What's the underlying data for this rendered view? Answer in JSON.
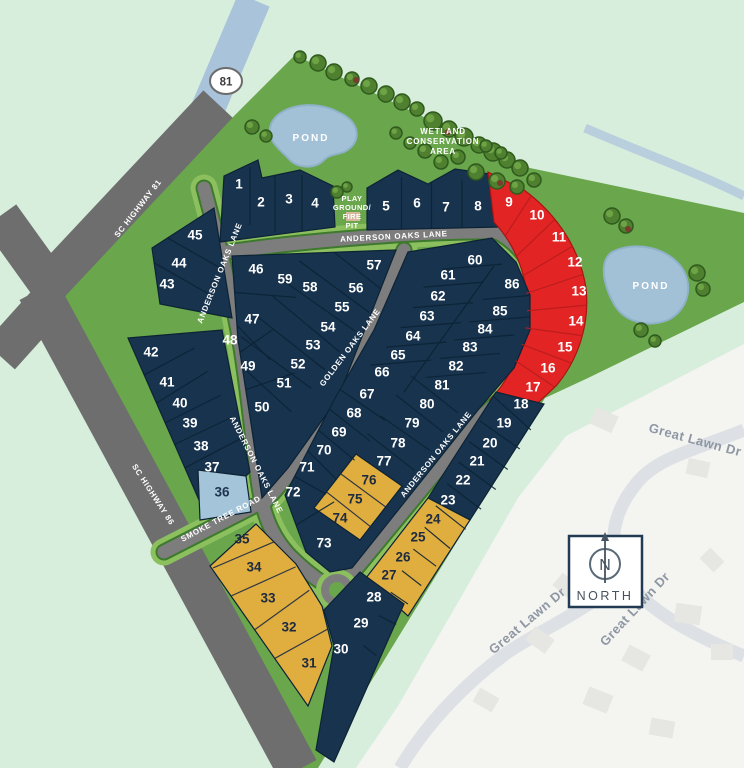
{
  "map_name": "anderson-oaks-site-plan",
  "colors": {
    "mint_background": "#d8eedd",
    "site_green": "#69a64c",
    "road_verge_green": "#8cc05f",
    "lot_navy": "#17334e",
    "lot_red": "#e32424",
    "lot_gold": "#e0ad3f",
    "lot_lightblue": "#a3c4d9",
    "highway_gray": "#6e6e6e",
    "street_gray": "#7d7d7d",
    "pond_blue": "#a3c1d6",
    "neighborhood_offwhite": "#f4f4f1",
    "neighborhood_road": "#dde1e6"
  },
  "highway_shield": "81",
  "compass": {
    "letter": "N",
    "label": "NORTH"
  },
  "road_labels": [
    {
      "text": "SC HIGHWAY 81",
      "x": 140,
      "y": 210,
      "rot": -52
    },
    {
      "text": "ANDERSON OAKS LANE",
      "x": 394,
      "y": 239,
      "rot": -3
    },
    {
      "text": "ANDERSON OAKS LANE",
      "x": 222,
      "y": 274,
      "rot": -68
    },
    {
      "text": "ANDERSON OAKS LANE",
      "x": 254,
      "y": 466,
      "rot": 63
    },
    {
      "text": "ANDERSON OAKS LANE",
      "x": 438,
      "y": 456,
      "rot": -51
    },
    {
      "text": "GOLDEN OAKS LANE",
      "x": 352,
      "y": 349,
      "rot": -53
    },
    {
      "text": "SMOKE TREE ROAD",
      "x": 222,
      "y": 521,
      "rot": -28
    },
    {
      "text": "SC HIGHWAY 86",
      "x": 151,
      "y": 496,
      "rot": 57
    }
  ],
  "area_labels": [
    {
      "text": "POND",
      "x": 311,
      "y": 141,
      "rot": 0,
      "cls": "lbl-area"
    },
    {
      "text": "POND",
      "x": 651,
      "y": 289,
      "rot": 0,
      "cls": "lbl-area"
    },
    {
      "text": "WETLAND",
      "x": 443,
      "y": 134,
      "rot": 0,
      "cls": "lbl-area-sm"
    },
    {
      "text": "CONSERVATION",
      "x": 443,
      "y": 144,
      "rot": 0,
      "cls": "lbl-area-sm"
    },
    {
      "text": "AREA",
      "x": 443,
      "y": 154,
      "rot": 0,
      "cls": "lbl-area-sm"
    },
    {
      "text": "PLAY",
      "x": 352,
      "y": 201,
      "rot": 0,
      "cls": "lbl-play"
    },
    {
      "text": "GROUND/",
      "x": 352,
      "y": 210,
      "rot": 0,
      "cls": "lbl-play"
    },
    {
      "text": "FIRE",
      "x": 352,
      "y": 219,
      "rot": 0,
      "cls": "lbl-play"
    },
    {
      "text": "PIT",
      "x": 352,
      "y": 228,
      "rot": 0,
      "cls": "lbl-play"
    }
  ],
  "street_labels": [
    {
      "text": "Great Lawn Dr",
      "x": 694,
      "y": 444,
      "rot": 15
    },
    {
      "text": "Great Lawn Dr",
      "x": 530,
      "y": 624,
      "rot": -40
    },
    {
      "text": "Great Lawn Dr",
      "x": 638,
      "y": 612,
      "rot": -47
    }
  ],
  "lots": [
    {
      "n": "1",
      "x": 239,
      "y": 184,
      "c": "navy"
    },
    {
      "n": "2",
      "x": 261,
      "y": 202,
      "c": "navy"
    },
    {
      "n": "3",
      "x": 289,
      "y": 199,
      "c": "navy"
    },
    {
      "n": "4",
      "x": 315,
      "y": 203,
      "c": "navy"
    },
    {
      "n": "5",
      "x": 386,
      "y": 206,
      "c": "navy"
    },
    {
      "n": "6",
      "x": 417,
      "y": 203,
      "c": "navy"
    },
    {
      "n": "7",
      "x": 446,
      "y": 207,
      "c": "navy"
    },
    {
      "n": "8",
      "x": 478,
      "y": 206,
      "c": "navy"
    },
    {
      "n": "9",
      "x": 509,
      "y": 202,
      "c": "red"
    },
    {
      "n": "10",
      "x": 537,
      "y": 215,
      "c": "red"
    },
    {
      "n": "11",
      "x": 559,
      "y": 237,
      "c": "red"
    },
    {
      "n": "12",
      "x": 575,
      "y": 262,
      "c": "red"
    },
    {
      "n": "13",
      "x": 579,
      "y": 291,
      "c": "red"
    },
    {
      "n": "14",
      "x": 576,
      "y": 321,
      "c": "red"
    },
    {
      "n": "15",
      "x": 565,
      "y": 347,
      "c": "red"
    },
    {
      "n": "16",
      "x": 548,
      "y": 368,
      "c": "red"
    },
    {
      "n": "17",
      "x": 533,
      "y": 387,
      "c": "red"
    },
    {
      "n": "18",
      "x": 521,
      "y": 404,
      "c": "navy"
    },
    {
      "n": "19",
      "x": 504,
      "y": 423,
      "c": "navy"
    },
    {
      "n": "20",
      "x": 490,
      "y": 443,
      "c": "navy"
    },
    {
      "n": "21",
      "x": 477,
      "y": 461,
      "c": "navy"
    },
    {
      "n": "22",
      "x": 463,
      "y": 480,
      "c": "navy"
    },
    {
      "n": "23",
      "x": 448,
      "y": 500,
      "c": "navy"
    },
    {
      "n": "24",
      "x": 433,
      "y": 519,
      "c": "gold"
    },
    {
      "n": "25",
      "x": 418,
      "y": 537,
      "c": "gold"
    },
    {
      "n": "26",
      "x": 403,
      "y": 557,
      "c": "gold"
    },
    {
      "n": "27",
      "x": 389,
      "y": 575,
      "c": "gold"
    },
    {
      "n": "28",
      "x": 374,
      "y": 597,
      "c": "navy"
    },
    {
      "n": "29",
      "x": 361,
      "y": 623,
      "c": "navy"
    },
    {
      "n": "30",
      "x": 341,
      "y": 649,
      "c": "navy"
    },
    {
      "n": "31",
      "x": 309,
      "y": 663,
      "c": "gold"
    },
    {
      "n": "32",
      "x": 289,
      "y": 627,
      "c": "gold"
    },
    {
      "n": "33",
      "x": 268,
      "y": 598,
      "c": "gold"
    },
    {
      "n": "34",
      "x": 254,
      "y": 567,
      "c": "gold"
    },
    {
      "n": "35",
      "x": 242,
      "y": 539,
      "c": "gold"
    },
    {
      "n": "36",
      "x": 222,
      "y": 492,
      "c": "blue"
    },
    {
      "n": "37",
      "x": 212,
      "y": 467,
      "c": "navy"
    },
    {
      "n": "38",
      "x": 201,
      "y": 446,
      "c": "navy"
    },
    {
      "n": "39",
      "x": 190,
      "y": 423,
      "c": "navy"
    },
    {
      "n": "40",
      "x": 180,
      "y": 403,
      "c": "navy"
    },
    {
      "n": "41",
      "x": 167,
      "y": 382,
      "c": "navy"
    },
    {
      "n": "42",
      "x": 151,
      "y": 352,
      "c": "navy"
    },
    {
      "n": "43",
      "x": 167,
      "y": 284,
      "c": "navy"
    },
    {
      "n": "44",
      "x": 179,
      "y": 263,
      "c": "navy"
    },
    {
      "n": "45",
      "x": 195,
      "y": 235,
      "c": "navy"
    },
    {
      "n": "46",
      "x": 256,
      "y": 269,
      "c": "navy"
    },
    {
      "n": "47",
      "x": 252,
      "y": 319,
      "c": "navy"
    },
    {
      "n": "48",
      "x": 230,
      "y": 340,
      "c": "navy"
    },
    {
      "n": "49",
      "x": 248,
      "y": 366,
      "c": "navy"
    },
    {
      "n": "50",
      "x": 262,
      "y": 407,
      "c": "navy"
    },
    {
      "n": "51",
      "x": 284,
      "y": 383,
      "c": "navy"
    },
    {
      "n": "52",
      "x": 298,
      "y": 364,
      "c": "navy"
    },
    {
      "n": "53",
      "x": 313,
      "y": 345,
      "c": "navy"
    },
    {
      "n": "54",
      "x": 328,
      "y": 327,
      "c": "navy"
    },
    {
      "n": "55",
      "x": 342,
      "y": 307,
      "c": "navy"
    },
    {
      "n": "56",
      "x": 356,
      "y": 288,
      "c": "navy"
    },
    {
      "n": "57",
      "x": 374,
      "y": 265,
      "c": "navy"
    },
    {
      "n": "58",
      "x": 310,
      "y": 287,
      "c": "navy"
    },
    {
      "n": "59",
      "x": 285,
      "y": 279,
      "c": "navy"
    },
    {
      "n": "60",
      "x": 475,
      "y": 260,
      "c": "navy"
    },
    {
      "n": "61",
      "x": 448,
      "y": 275,
      "c": "navy"
    },
    {
      "n": "62",
      "x": 438,
      "y": 296,
      "c": "navy"
    },
    {
      "n": "63",
      "x": 427,
      "y": 316,
      "c": "navy"
    },
    {
      "n": "64",
      "x": 413,
      "y": 336,
      "c": "navy"
    },
    {
      "n": "65",
      "x": 398,
      "y": 355,
      "c": "navy"
    },
    {
      "n": "66",
      "x": 382,
      "y": 372,
      "c": "navy"
    },
    {
      "n": "67",
      "x": 367,
      "y": 394,
      "c": "navy"
    },
    {
      "n": "68",
      "x": 354,
      "y": 413,
      "c": "navy"
    },
    {
      "n": "69",
      "x": 339,
      "y": 432,
      "c": "navy"
    },
    {
      "n": "70",
      "x": 324,
      "y": 450,
      "c": "navy"
    },
    {
      "n": "71",
      "x": 307,
      "y": 467,
      "c": "navy"
    },
    {
      "n": "72",
      "x": 293,
      "y": 492,
      "c": "navy"
    },
    {
      "n": "73",
      "x": 324,
      "y": 543,
      "c": "navy"
    },
    {
      "n": "74",
      "x": 340,
      "y": 518,
      "c": "gold"
    },
    {
      "n": "75",
      "x": 355,
      "y": 499,
      "c": "gold"
    },
    {
      "n": "76",
      "x": 369,
      "y": 480,
      "c": "gold"
    },
    {
      "n": "77",
      "x": 384,
      "y": 461,
      "c": "navy"
    },
    {
      "n": "78",
      "x": 398,
      "y": 443,
      "c": "navy"
    },
    {
      "n": "79",
      "x": 412,
      "y": 423,
      "c": "navy"
    },
    {
      "n": "80",
      "x": 427,
      "y": 404,
      "c": "navy"
    },
    {
      "n": "81",
      "x": 442,
      "y": 385,
      "c": "navy"
    },
    {
      "n": "82",
      "x": 456,
      "y": 366,
      "c": "navy"
    },
    {
      "n": "83",
      "x": 470,
      "y": 347,
      "c": "navy"
    },
    {
      "n": "84",
      "x": 485,
      "y": 329,
      "c": "navy"
    },
    {
      "n": "85",
      "x": 500,
      "y": 311,
      "c": "navy"
    },
    {
      "n": "86",
      "x": 512,
      "y": 284,
      "c": "navy"
    }
  ]
}
